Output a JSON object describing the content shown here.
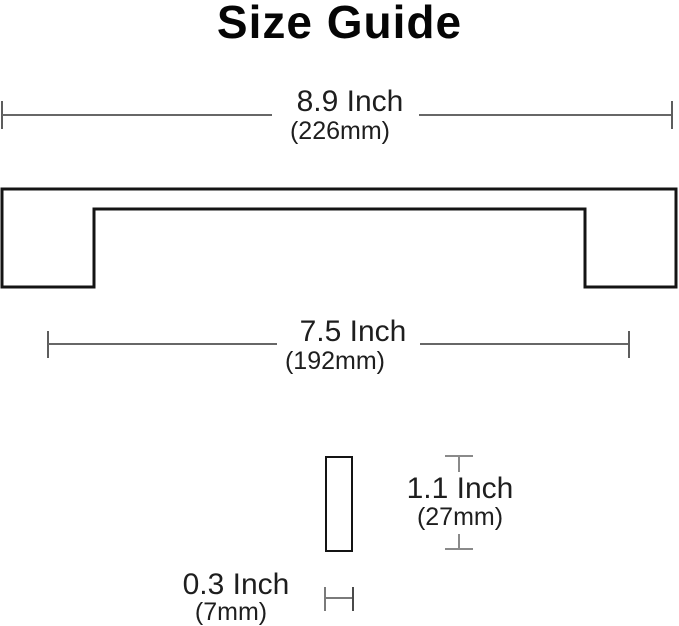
{
  "title": "Size Guide",
  "diagram": {
    "overall_length": {
      "inch": "8.9 Inch",
      "mm": "(226mm)"
    },
    "center_to_center": {
      "inch": "7.5 Inch",
      "mm": "(192mm)"
    },
    "height": {
      "inch": "1.1 Inch",
      "mm": "(27mm)"
    },
    "thickness": {
      "inch": "0.3 Inch",
      "mm": "(7mm)"
    }
  },
  "colors": {
    "background": "#ffffff",
    "title_text": "#050505",
    "dimension_text": "#1e1e1e",
    "dimension_line": "#676767",
    "outline": "#141414"
  }
}
